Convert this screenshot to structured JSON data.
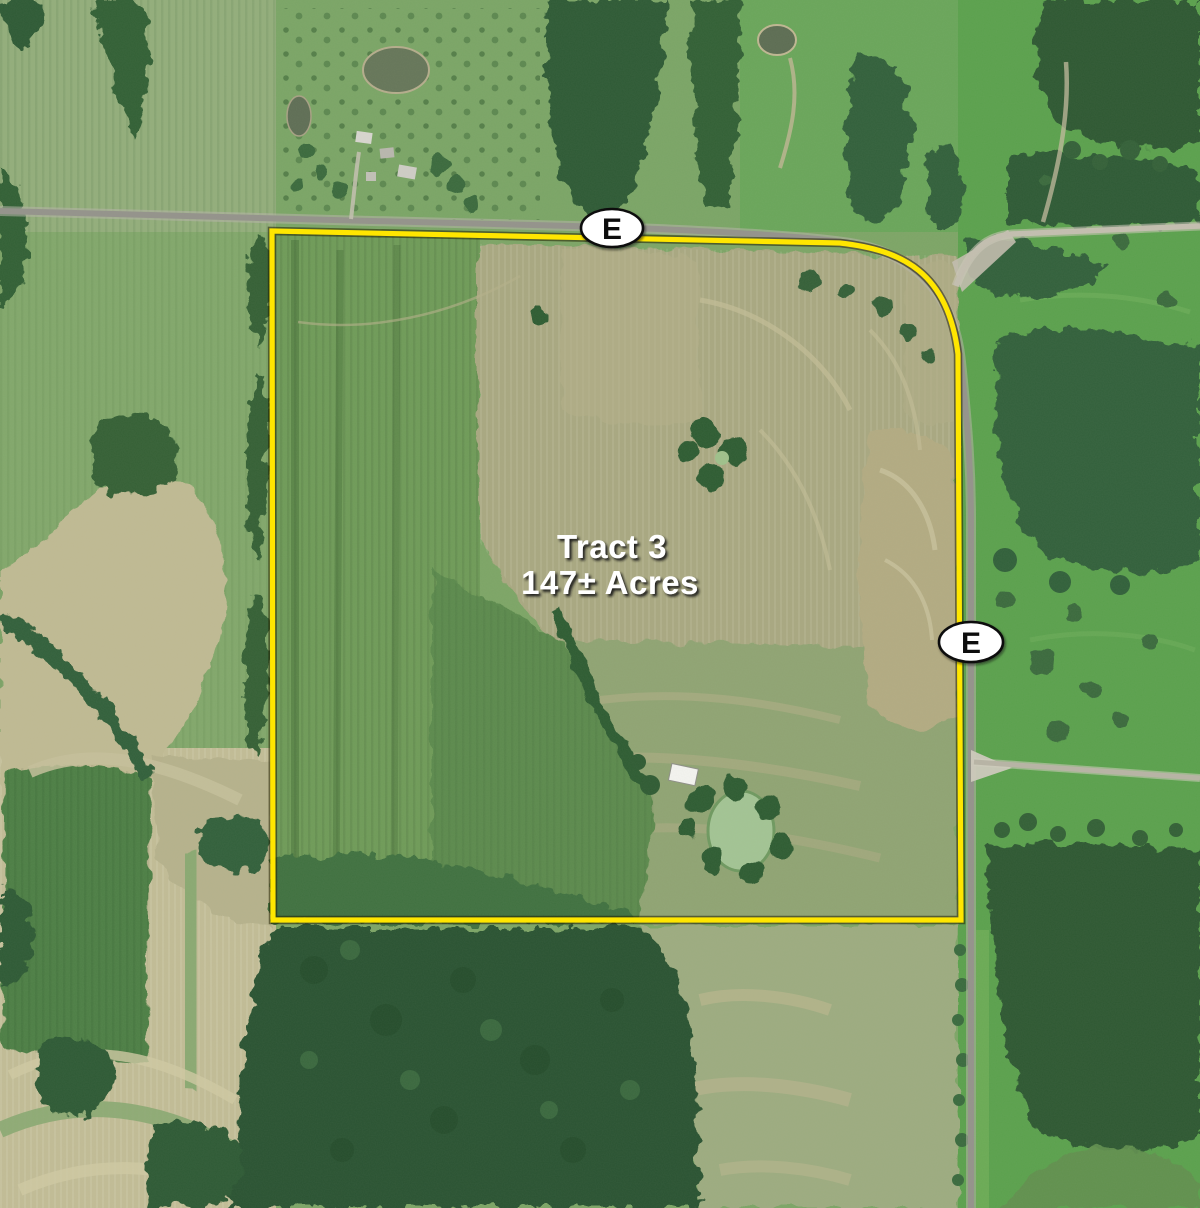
{
  "map": {
    "title": {
      "tract": "Tract 3",
      "acreage": "147± Acres"
    },
    "road_markers": [
      {
        "label": "E",
        "position": "top-road"
      },
      {
        "label": "E",
        "position": "east-road"
      }
    ],
    "colors": {
      "boundary_yellow": "#FFE600",
      "badge_fill": "#FFFFFF",
      "badge_border": "#0F0F0F",
      "badge_text": "#111111",
      "label_text": "#FFFFFF",
      "label_shadow": "#141414",
      "forest_green": "#2E5833",
      "pasture_green": "#5BA14D",
      "crop_green": "#6F9B58",
      "harvested_tan": "#A9A881",
      "bare_tan": "#B3AB82",
      "road_gray": "#94938B",
      "gravel_light": "#C4BFB0"
    }
  }
}
